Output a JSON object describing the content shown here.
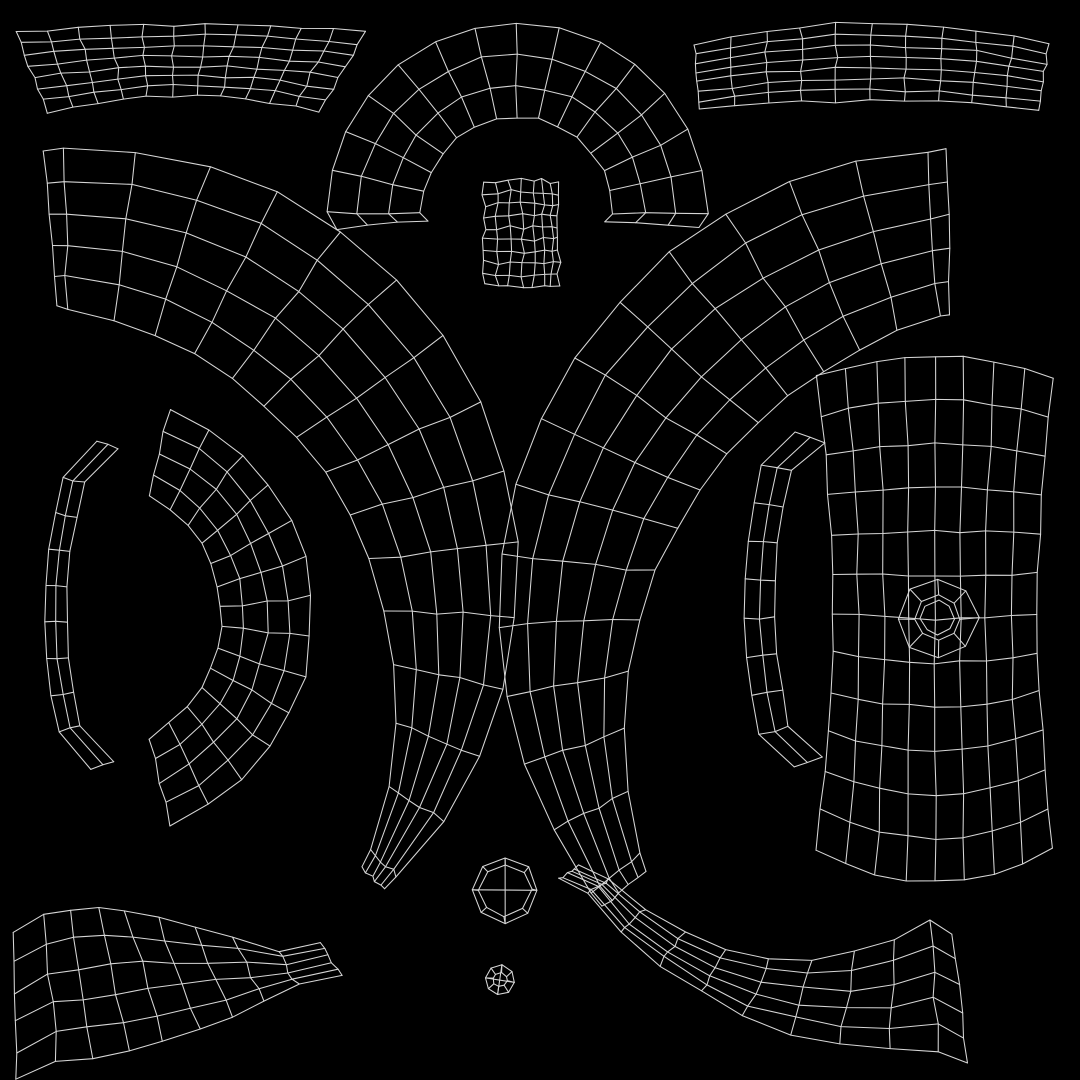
{
  "meta": {
    "title": "UV wireframe layout",
    "background_color": "#000000",
    "stroke_color": "#d6d6d6",
    "stroke_width": 1.05,
    "canvas_width": 1080,
    "canvas_height": 1080
  },
  "pieces": [
    {
      "name": "top-left-band",
      "type": "rectgrid",
      "x0": 15,
      "x1": 365,
      "xb0": 48,
      "xb1": 320,
      "yt_c": 32,
      "yt_m": 25,
      "yb_c": 112,
      "yb_m": 96,
      "pinch": 0,
      "cols": 11,
      "rows": 7,
      "jitter": 1.6,
      "seed": 1
    },
    {
      "name": "top-arch-half-ring",
      "type": "arcgrid",
      "cx": 517,
      "cy": 213,
      "a0": 180,
      "a1": 360,
      "r_in": [
        96
      ],
      "r_out": [
        190
      ],
      "rows": 3,
      "cols": 14,
      "jitter": 1.5,
      "seed": 2,
      "hook": {
        "dang": 5,
        "dr": -8
      }
    },
    {
      "name": "top-right-band",
      "type": "rectgrid",
      "x0": 695,
      "x1": 1048,
      "xb0": 700,
      "xb1": 1040,
      "yt_c": 45,
      "yt_m": 23,
      "yb_c": 110,
      "yb_m": 101,
      "pinch": 0,
      "cols": 10,
      "rows": 7,
      "jitter": 1.6,
      "seed": 3
    },
    {
      "name": "small-square-patch",
      "type": "rectgrid",
      "x0": 484,
      "x1": 559,
      "yt_c": 183,
      "yt_m": 179,
      "yb_c": 284,
      "yb_m": 288,
      "pinch": 0,
      "cols": 7,
      "rows": 9,
      "col_fracs": [
        0,
        0.17,
        0.34,
        0.51,
        0.66,
        0.78,
        0.9,
        1
      ],
      "jitter": 2.2,
      "seed": 4
    },
    {
      "name": "large-left-c-ring",
      "type": "arcgrid",
      "cx": 75,
      "cy": 590,
      "a0": 266,
      "a1": 404,
      "r_in": [
        285,
        276,
        400
      ],
      "r_out": [
        440,
        446,
        430
      ],
      "rows": 5,
      "cols": 16,
      "slivers": 0.018,
      "jitter": 2,
      "seed": 5
    },
    {
      "name": "large-right-c-ring",
      "type": "arcgrid",
      "cx": 961,
      "cy": 606,
      "a0": 268,
      "a1": 140,
      "r_in": [
        292,
        285,
        413
      ],
      "r_out": [
        456,
        460,
        468
      ],
      "rows": 5,
      "cols": 16,
      "slivers": 0.018,
      "jitter": 2,
      "seed": 6
    },
    {
      "name": "medium-c-ring",
      "type": "arcgrid",
      "cx": 118,
      "cy": 617,
      "a0": 284,
      "a1": 436,
      "r_in": [
        125,
        104,
        125
      ],
      "r_out": [
        215,
        194,
        215
      ],
      "rows": 4,
      "cols": 13,
      "jitter": 2,
      "seed": 7
    },
    {
      "name": "left-thin-strip",
      "type": "arcgrid",
      "cx": 570,
      "cy": 613,
      "a0": 195,
      "a1": 167,
      "r_in": [
        503
      ],
      "r_out": [
        525
      ],
      "rows": 2,
      "cols": 7,
      "jitter": 1.2,
      "seed": 8,
      "hook": {
        "dang": 5,
        "dr": -22
      }
    },
    {
      "name": "right-thin-strip",
      "type": "arcgrid",
      "cx": 1323,
      "cy": 604,
      "a0": 194,
      "a1": 167,
      "r_in": [
        548
      ],
      "r_out": [
        578
      ],
      "rows": 2,
      "cols": 7,
      "jitter": 1.2,
      "seed": 9,
      "hook": {
        "dang": 4,
        "dr": -24
      }
    },
    {
      "name": "bottom-left-band",
      "type": "arcgrid",
      "cx": 0,
      "cy": 470,
      "a0": 84.5,
      "a1": 60,
      "r_in": [
        447,
        465,
        555
      ],
      "r_out": [
        595
      ],
      "rows": 5,
      "cols": 7,
      "jitter": 2,
      "seed": 10,
      "hook": {
        "dang": 4,
        "dr": 16
      }
    },
    {
      "name": "bottom-right-band",
      "type": "arcgrid",
      "cx": 910,
      "cy": 643,
      "a0": 142,
      "a1": 86,
      "r_in": [
        383,
        345,
        277
      ],
      "r_out": [
        408
      ],
      "rows": 5,
      "cols": 8,
      "jitter": 2,
      "seed": 11,
      "hook": {
        "dang": 4,
        "dr": 16
      }
    },
    {
      "name": "right-panel-grid",
      "type": "rectgrid",
      "x0": 817,
      "x1": 1053,
      "yt_c": 377,
      "yt_m": 356,
      "yb_c": 849,
      "yb_m": 882,
      "pinch": 16,
      "cols": 8,
      "rows": 12,
      "jitter": 1.5,
      "seed": 12
    },
    {
      "name": "panel-pole-octagon",
      "type": "polefan",
      "cx": 938,
      "cy": 618,
      "rings": [
        40,
        22,
        17
      ],
      "nseg": 8,
      "rot": 0,
      "spokes": {
        "from": 0,
        "to": 1
      },
      "cross": false,
      "jitter": 1.5,
      "seed": 13
    },
    {
      "name": "octagon-cap",
      "type": "polefan",
      "cx": 505,
      "cy": 890,
      "rings": [
        33,
        26
      ],
      "nseg": 8,
      "rot": 0,
      "spokes": {
        "from": 0,
        "to": 1
      },
      "cross": true,
      "jitter": 1.2,
      "seed": 14
    },
    {
      "name": "tiny-circle-cap",
      "type": "polefan",
      "cx": 500,
      "cy": 980,
      "rings": [
        15,
        7
      ],
      "nseg": 8,
      "rot": 10,
      "spokes": {
        "from": 0,
        "to": 1
      },
      "cross": true,
      "jitter": 0.8,
      "seed": 15
    }
  ]
}
